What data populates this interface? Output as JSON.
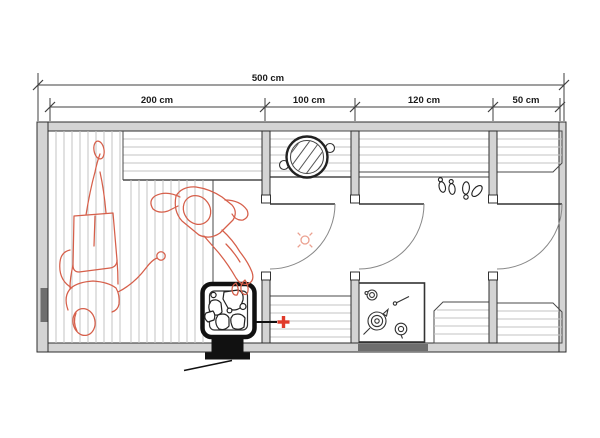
{
  "dimensions": {
    "total": {
      "label": "500 cm",
      "value_cm": 500
    },
    "segments": [
      {
        "label": "200 cm",
        "value_cm": 200
      },
      {
        "label": "100 cm",
        "value_cm": 100
      },
      {
        "label": "120 cm",
        "value_cm": 120
      },
      {
        "label": "50 cm",
        "value_cm": 50
      }
    ]
  },
  "fixtures": {
    "heater": "sauna-heater-with-stones-and-chimney",
    "heater_connection": "pipe-to-red-plus-marker",
    "cauldron": "hatched-round-pot-on-bench",
    "stove_counter": "counter-with-kettle-and-ladles",
    "bathers": "two-red-outline-figures-on-benches",
    "footprints": "two-pairs-of-footprints",
    "light": "red-light-point-symbol",
    "doors": "three-swing-doors",
    "window": "dark-segment-on-left-wall"
  },
  "colors": {
    "wall_stroke": "#2e2e2e",
    "wall_fill": "#d4d4d4",
    "dark_fill": "#6e6e6e",
    "line": "#4a4a4a",
    "plank": "#c3c3c3",
    "figure_red": "#d65f4a",
    "accent_red": "#e03a2a",
    "light_red": "#eba08f"
  }
}
